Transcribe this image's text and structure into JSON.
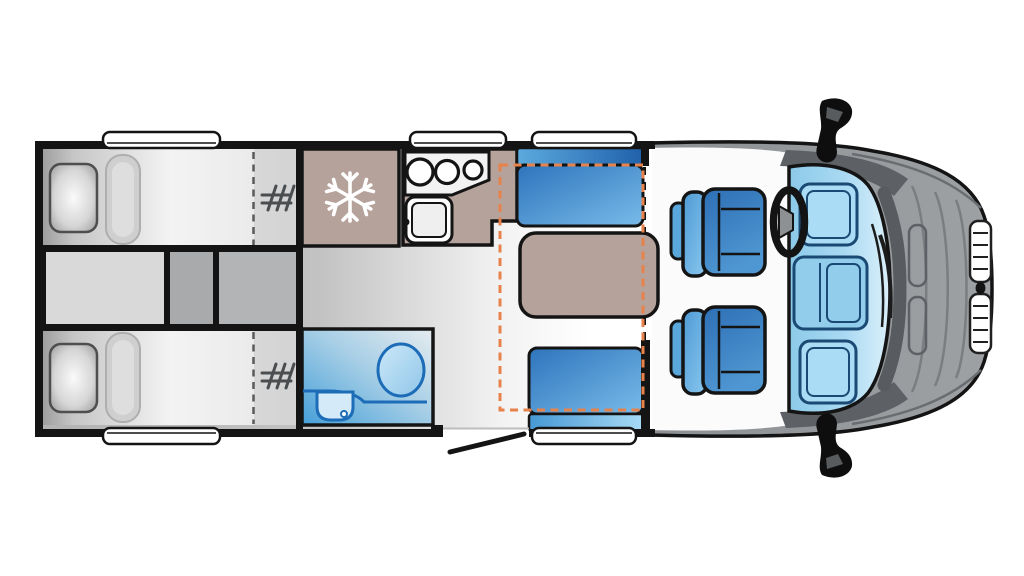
{
  "page": {
    "description": "Top-down floor plan diagram of a motorhome / campervan with rear twin single beds, kitchen, bathroom, dinette lounge and driver cab on the right",
    "background": "#ffffff"
  },
  "colors": {
    "wall_black": "#141414",
    "furniture_tan": "#b5a29a",
    "accent_orange": "#e8824b",
    "bench_blue_dark": "#2e74bc",
    "bench_blue_light": "#78bbe9",
    "bathroom_blue": "#459fd8",
    "fixture_blue": "#1d6cb8",
    "cab_body_gray": "#96999c",
    "windscreen_blue": "#a9d9f2",
    "floor_gray": "#bfbfbf",
    "window_white": "#ffffff",
    "snowflake_white": "#ffffff",
    "bed_dash_gray": "#5a5a5a"
  },
  "vehicle": {
    "type": "motorhome floor plan",
    "view": "top-down",
    "cab_position": "right",
    "windows": 5,
    "entry_doors": 1,
    "wing_mirrors": 2
  },
  "zones": {
    "bedroom": {
      "name": "rear twin single beds",
      "single_beds": 2,
      "pillows": 2,
      "bed_extension_marks": 2,
      "center_units": 3
    },
    "kitchen": {
      "name": "kitchen",
      "fridge_freezer": 1,
      "hob_burners": 3,
      "sink": 1
    },
    "bathroom": {
      "name": "washroom",
      "toilet": 1,
      "washbasin": 1
    },
    "lounge": {
      "name": "dinette lounge",
      "bench_seats": 2,
      "table": 1,
      "drop_down_bed_outline": 1
    },
    "cab": {
      "name": "driver cab",
      "swivel_seats": 2,
      "steering_wheel": 1,
      "windscreen": 1,
      "grille_sections": 2,
      "bonnet_vents": 2
    }
  },
  "icons": [
    {
      "name": "snowflake-icon",
      "meaning": "fridge / freezer"
    },
    {
      "name": "hob-burners-icon",
      "meaning": "3-ring gas hob"
    },
    {
      "name": "toilet-icon",
      "meaning": "toilet"
    },
    {
      "name": "washbasin-icon",
      "meaning": "washbasin"
    },
    {
      "name": "bed-extension-hatch-icon",
      "meaning": "slatted bed extension"
    }
  ]
}
